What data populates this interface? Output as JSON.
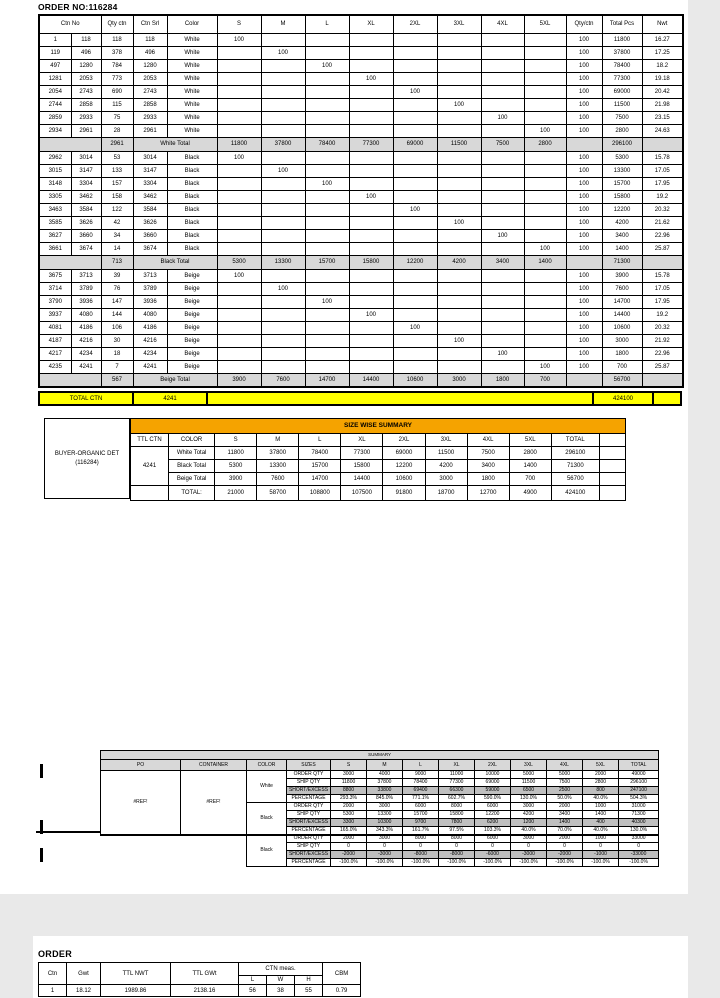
{
  "title": "ORDER NO:116284",
  "main_table": {
    "headers": {
      "ctn_no": "Ctn No",
      "qty_ctn": "Qty ctn",
      "ctn_srl": "Ctn Srl",
      "color": "Color",
      "sizes": [
        "S",
        "M",
        "L",
        "XL",
        "2XL",
        "3XL",
        "4XL",
        "5XL"
      ],
      "qty_per_ctn": "Qty/ctn",
      "total_pcs": "Total Pcs",
      "nwt": "Nwt"
    },
    "sections": [
      {
        "name": "White",
        "rows": [
          {
            "start": "1",
            "end": "118",
            "qty": "118",
            "srl": "118",
            "color": "White",
            "size_index": 0,
            "size_qty": "100",
            "qty_per_ctn": "100",
            "total": "11800",
            "nwt": "16.27"
          },
          {
            "start": "119",
            "end": "496",
            "qty": "378",
            "srl": "496",
            "color": "White",
            "size_index": 1,
            "size_qty": "100",
            "qty_per_ctn": "100",
            "total": "37800",
            "nwt": "17.25"
          },
          {
            "start": "497",
            "end": "1280",
            "qty": "784",
            "srl": "1280",
            "color": "White",
            "size_index": 2,
            "size_qty": "100",
            "qty_per_ctn": "100",
            "total": "78400",
            "nwt": "18.2"
          },
          {
            "start": "1281",
            "end": "2053",
            "qty": "773",
            "srl": "2053",
            "color": "White",
            "size_index": 3,
            "size_qty": "100",
            "qty_per_ctn": "100",
            "total": "77300",
            "nwt": "19.18"
          },
          {
            "start": "2054",
            "end": "2743",
            "qty": "690",
            "srl": "2743",
            "color": "White",
            "size_index": 4,
            "size_qty": "100",
            "qty_per_ctn": "100",
            "total": "69000",
            "nwt": "20.42"
          },
          {
            "start": "2744",
            "end": "2858",
            "qty": "115",
            "srl": "2858",
            "color": "White",
            "size_index": 5,
            "size_qty": "100",
            "qty_per_ctn": "100",
            "total": "11500",
            "nwt": "21.98"
          },
          {
            "start": "2859",
            "end": "2933",
            "qty": "75",
            "srl": "2933",
            "color": "White",
            "size_index": 6,
            "size_qty": "100",
            "qty_per_ctn": "100",
            "total": "7500",
            "nwt": "23.15"
          },
          {
            "start": "2934",
            "end": "2961",
            "qty": "28",
            "srl": "2961",
            "color": "White",
            "size_index": 7,
            "size_qty": "100",
            "qty_per_ctn": "100",
            "total": "2800",
            "nwt": "24.63"
          }
        ],
        "total": {
          "qty": "2961",
          "label": "White Total",
          "sizes": [
            "11800",
            "37800",
            "78400",
            "77300",
            "69000",
            "11500",
            "7500",
            "2800"
          ],
          "total": "296100"
        }
      },
      {
        "name": "Black",
        "rows": [
          {
            "start": "2962",
            "end": "3014",
            "qty": "53",
            "srl": "3014",
            "color": "Black",
            "size_index": 0,
            "size_qty": "100",
            "qty_per_ctn": "100",
            "total": "5300",
            "nwt": "15.78"
          },
          {
            "start": "3015",
            "end": "3147",
            "qty": "133",
            "srl": "3147",
            "color": "Black",
            "size_index": 1,
            "size_qty": "100",
            "qty_per_ctn": "100",
            "total": "13300",
            "nwt": "17.05"
          },
          {
            "start": "3148",
            "end": "3304",
            "qty": "157",
            "srl": "3304",
            "color": "Black",
            "size_index": 2,
            "size_qty": "100",
            "qty_per_ctn": "100",
            "total": "15700",
            "nwt": "17.95"
          },
          {
            "start": "3305",
            "end": "3462",
            "qty": "158",
            "srl": "3462",
            "color": "Black",
            "size_index": 3,
            "size_qty": "100",
            "qty_per_ctn": "100",
            "total": "15800",
            "nwt": "19.2"
          },
          {
            "start": "3463",
            "end": "3584",
            "qty": "122",
            "srl": "3584",
            "color": "Black",
            "size_index": 4,
            "size_qty": "100",
            "qty_per_ctn": "100",
            "total": "12200",
            "nwt": "20.32"
          },
          {
            "start": "3585",
            "end": "3626",
            "qty": "42",
            "srl": "3626",
            "color": "Black",
            "size_index": 5,
            "size_qty": "100",
            "qty_per_ctn": "100",
            "total": "4200",
            "nwt": "21.62"
          },
          {
            "start": "3627",
            "end": "3660",
            "qty": "34",
            "srl": "3660",
            "color": "Black",
            "size_index": 6,
            "size_qty": "100",
            "qty_per_ctn": "100",
            "total": "3400",
            "nwt": "22.96"
          },
          {
            "start": "3661",
            "end": "3674",
            "qty": "14",
            "srl": "3674",
            "color": "Black",
            "size_index": 7,
            "size_qty": "100",
            "qty_per_ctn": "100",
            "total": "1400",
            "nwt": "25.87"
          }
        ],
        "total": {
          "qty": "713",
          "label": "Black Total",
          "sizes": [
            "5300",
            "13300",
            "15700",
            "15800",
            "12200",
            "4200",
            "3400",
            "1400"
          ],
          "total": "71300"
        }
      },
      {
        "name": "Beige",
        "rows": [
          {
            "start": "3675",
            "end": "3713",
            "qty": "39",
            "srl": "3713",
            "color": "Beige",
            "size_index": 0,
            "size_qty": "100",
            "qty_per_ctn": "100",
            "total": "3900",
            "nwt": "15.78"
          },
          {
            "start": "3714",
            "end": "3789",
            "qty": "76",
            "srl": "3789",
            "color": "Beige",
            "size_index": 1,
            "size_qty": "100",
            "qty_per_ctn": "100",
            "total": "7600",
            "nwt": "17.05"
          },
          {
            "start": "3790",
            "end": "3936",
            "qty": "147",
            "srl": "3936",
            "color": "Beige",
            "size_index": 2,
            "size_qty": "100",
            "qty_per_ctn": "100",
            "total": "14700",
            "nwt": "17.95"
          },
          {
            "start": "3937",
            "end": "4080",
            "qty": "144",
            "srl": "4080",
            "color": "Beige",
            "size_index": 3,
            "size_qty": "100",
            "qty_per_ctn": "100",
            "total": "14400",
            "nwt": "19.2"
          },
          {
            "start": "4081",
            "end": "4186",
            "qty": "106",
            "srl": "4186",
            "color": "Beige",
            "size_index": 4,
            "size_qty": "100",
            "qty_per_ctn": "100",
            "total": "10600",
            "nwt": "20.32"
          },
          {
            "start": "4187",
            "end": "4216",
            "qty": "30",
            "srl": "4216",
            "color": "Beige",
            "size_index": 5,
            "size_qty": "100",
            "qty_per_ctn": "100",
            "total": "3000",
            "nwt": "21.92"
          },
          {
            "start": "4217",
            "end": "4234",
            "qty": "18",
            "srl": "4234",
            "color": "Beige",
            "size_index": 6,
            "size_qty": "100",
            "qty_per_ctn": "100",
            "total": "1800",
            "nwt": "22.96"
          },
          {
            "start": "4235",
            "end": "4241",
            "qty": "7",
            "srl": "4241",
            "color": "Beige",
            "size_index": 7,
            "size_qty": "100",
            "qty_per_ctn": "100",
            "total": "700",
            "nwt": "25.87"
          }
        ],
        "total": {
          "qty": "567",
          "label": "Beige Total",
          "sizes": [
            "3900",
            "7600",
            "14700",
            "14400",
            "10600",
            "3000",
            "1800",
            "700"
          ],
          "total": "56700"
        }
      }
    ]
  },
  "total_ctn_bar": {
    "label": "TOTAL CTN",
    "ctn": "4241",
    "total": "424100"
  },
  "size_summary": {
    "buyer_line1": "BUYER-ORGANIC DET",
    "buyer_line2": "(116284)",
    "title": "SIZE WISE SUMMARY",
    "headers": [
      "TTL CTN",
      "COLOR",
      "S",
      "M",
      "L",
      "XL",
      "2XL",
      "3XL",
      "4XL",
      "5XL",
      "TOTAL"
    ],
    "ttl_ctn": "4241",
    "rows": [
      {
        "label": "White Total",
        "values": [
          "11800",
          "37800",
          "78400",
          "77300",
          "69000",
          "11500",
          "7500",
          "2800",
          "296100"
        ]
      },
      {
        "label": "Black Total",
        "values": [
          "5300",
          "13300",
          "15700",
          "15800",
          "12200",
          "4200",
          "3400",
          "1400",
          "71300"
        ]
      },
      {
        "label": "Beige Total",
        "values": [
          "3900",
          "7600",
          "14700",
          "14400",
          "10600",
          "3000",
          "1800",
          "700",
          "56700"
        ]
      }
    ],
    "total_row": {
      "label": "TOTAL:",
      "values": [
        "21000",
        "58700",
        "108800",
        "107500",
        "91800",
        "18700",
        "12700",
        "4900",
        "424100"
      ]
    }
  },
  "summary_table": {
    "title": "SUMMARY",
    "headers": [
      "PO",
      "CONTAINER",
      "COLOR",
      "SIZES",
      "S",
      "M",
      "L",
      "XL",
      "2XL",
      "3XL",
      "4XL",
      "5XL",
      "TOTAL"
    ],
    "po": "#REF!",
    "container": "#REF!",
    "groups": [
      {
        "color": "White",
        "rows": [
          {
            "label": "ORDER QTY",
            "values": [
              "3000",
              "4000",
              "9000",
              "11000",
              "10000",
              "5000",
              "5000",
              "2000",
              "49000"
            ],
            "highlight": false
          },
          {
            "label": "SHIP QTY",
            "values": [
              "11800",
              "37800",
              "78400",
              "77300",
              "69000",
              "11500",
              "7500",
              "2800",
              "296100"
            ],
            "highlight": false
          },
          {
            "label": "SHORT/EXCESS",
            "values": [
              "8800",
              "33800",
              "69400",
              "66300",
              "59000",
              "6500",
              "2500",
              "800",
              "247100"
            ],
            "highlight": true
          },
          {
            "label": "PERCENTAGE",
            "values": [
              "293.3%",
              "845.0%",
              "771.1%",
              "602.7%",
              "590.0%",
              "130.0%",
              "50.0%",
              "40.0%",
              "504.3%"
            ],
            "highlight": false
          }
        ]
      },
      {
        "color": "Black",
        "rows": [
          {
            "label": "ORDER QTY",
            "values": [
              "2000",
              "3000",
              "6000",
              "8000",
              "6000",
              "3000",
              "2000",
              "1000",
              "31000"
            ],
            "highlight": false
          },
          {
            "label": "SHIP QTY",
            "values": [
              "5300",
              "13300",
              "15700",
              "15800",
              "12200",
              "4200",
              "3400",
              "1400",
              "71300"
            ],
            "highlight": false
          },
          {
            "label": "SHORT/EXCESS",
            "values": [
              "3300",
              "10300",
              "9700",
              "7800",
              "6200",
              "1200",
              "1400",
              "400",
              "40300"
            ],
            "highlight": true
          },
          {
            "label": "PERCENTAGE",
            "values": [
              "165.0%",
              "343.3%",
              "161.7%",
              "97.5%",
              "103.3%",
              "40.0%",
              "70.0%",
              "40.0%",
              "130.0%"
            ],
            "highlight": false
          }
        ]
      },
      {
        "color": "Black",
        "rows": [
          {
            "label": "ORDER QTY",
            "values": [
              "2000",
              "3000",
              "8000",
              "8000",
              "6000",
              "3000",
              "2000",
              "1000",
              "33000"
            ],
            "highlight": false
          },
          {
            "label": "SHIP QTY",
            "values": [
              "0",
              "0",
              "0",
              "0",
              "0",
              "0",
              "0",
              "0",
              "0"
            ],
            "highlight": false
          },
          {
            "label": "SHORT/EXCESS",
            "values": [
              "-2000",
              "-3000",
              "-8000",
              "-8000",
              "-6000",
              "-3000",
              "-2000",
              "-1000",
              "-33000"
            ],
            "highlight": true
          },
          {
            "label": "PERCENTAGE",
            "values": [
              "-100.0%",
              "-100.0%",
              "-100.0%",
              "-100.0%",
              "-100.0%",
              "-100.0%",
              "-100.0%",
              "-100.0%",
              "-100.0%"
            ],
            "highlight": false
          }
        ]
      }
    ]
  },
  "page2": {
    "title": "ORDER",
    "order_table": {
      "headers": {
        "ctn": "Ctn",
        "gwt": "Gwt",
        "ttl_nwt": "TTL NWT",
        "ttl_gwt": "TTL GWt",
        "ctn_meas": "CTN meas.",
        "l": "L",
        "w": "W",
        "h": "H",
        "cbm": "CBM"
      },
      "row": {
        "ctn": "1",
        "gwt": "18.12",
        "ttl_nwt": "1989.86",
        "ttl_gwt": "2138.16",
        "l": "56",
        "w": "38",
        "h": "55",
        "cbm": "0.79"
      }
    }
  },
  "colors": {
    "total_ctn_yellow": "#ffff00",
    "summary_orange": "#f5a300",
    "total_row_gray": "#d8d8d8",
    "short_excess_gray": "#bfbfbf"
  }
}
